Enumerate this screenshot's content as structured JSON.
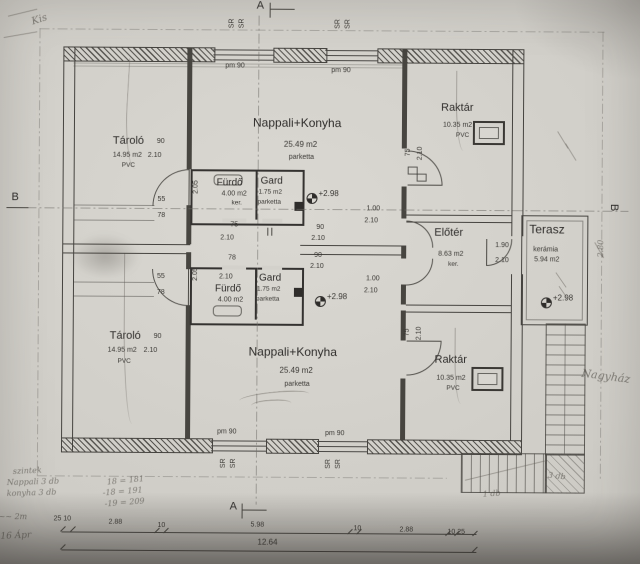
{
  "labels": {
    "a": "A",
    "b": "B",
    "sr": "SR",
    "pm": "pm 90",
    "level": "+2.98"
  },
  "rooms": {
    "tarolo_top": {
      "name": "Tároló",
      "area": "14.95 m2",
      "floor": "PVC"
    },
    "tarolo_bottom": {
      "name": "Tároló",
      "area": "14.95 m2",
      "floor": "PVC"
    },
    "nappali_top": {
      "name": "Nappali+Konyha",
      "area": "25.49 m2",
      "floor": "parketta"
    },
    "nappali_bottom": {
      "name": "Nappali+Konyha",
      "area": "25.49 m2",
      "floor": "parketta"
    },
    "raktar_top": {
      "name": "Raktár",
      "area": "10.35 m2",
      "floor": "PVC"
    },
    "raktar_bottom": {
      "name": "Raktár",
      "area": "10.35 m2",
      "floor": "PVC"
    },
    "furdo_top": {
      "name": "Fürdő",
      "area": "4.00 m2",
      "floor": "ker."
    },
    "furdo_bottom": {
      "name": "Fürdő",
      "area": "4.00 m2",
      "floor": "ker."
    },
    "gard_top": {
      "name": "Gard",
      "area": "1.75 m2",
      "floor": "parketta"
    },
    "gard_bottom": {
      "name": "Gard",
      "area": "1.75 m2",
      "floor": "parketta"
    },
    "eloter": {
      "name": "Előtér",
      "area": "8.63 m2",
      "floor": "ker."
    },
    "terasz": {
      "name": "Terasz",
      "area": "5.94 m2",
      "floor": "kerámia"
    }
  },
  "dims": {
    "d90": "90",
    "d210": "2.10",
    "d100": "1.00",
    "d190": "1.90",
    "d55": "55",
    "d78": "78",
    "d75": "75",
    "d205": "2.05"
  },
  "bottom_dims": {
    "c0": "25 10",
    "c1": "2.88",
    "c2": "10",
    "c3": "5.98",
    "c4": "10",
    "c5": "2.88",
    "c6": "10 25",
    "total": "12.64"
  },
  "handwriting": {
    "top_left": "Kis",
    "right_margin": "Nagyház",
    "v280": "2.80",
    "line1": "szintek",
    "line2": "Nappali 3 db",
    "line3": "konyha 3 db",
    "calc1": "18 = 181",
    "calc2": "-18 = 191",
    "calc3": "-19 = 209",
    "note_2m": "~~ 2m",
    "note_date": "16 Ápr",
    "stairs1": "3 db",
    "stairs2": "1 db"
  }
}
